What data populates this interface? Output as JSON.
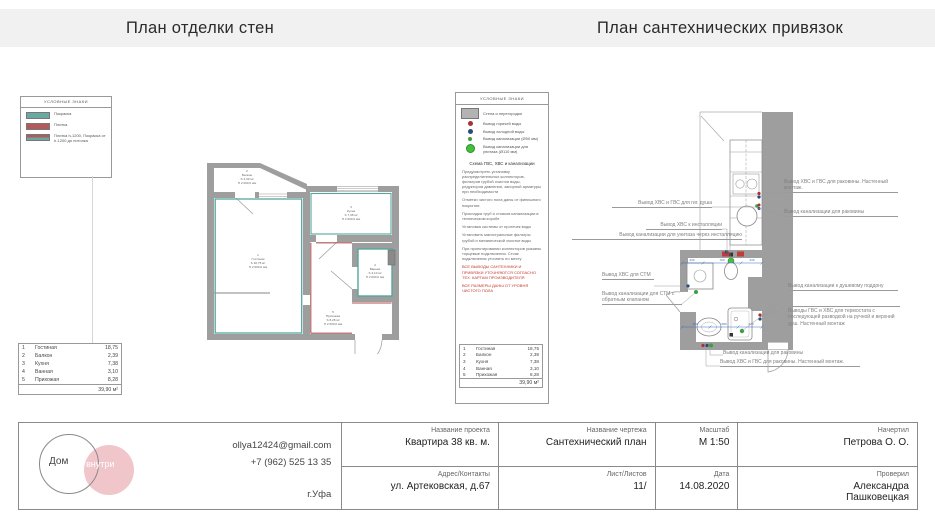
{
  "header": {
    "left_title": "План отделки стен",
    "right_title": "План сантехнических привязок"
  },
  "finish_legend": {
    "title": "УСЛОВНЫЕ ЗНАКИ",
    "items": {
      "paint": "Покраска",
      "tile": "Плитка",
      "mixed": "Плитка h-1200, Покраска от h-1200 до потолка"
    }
  },
  "rooms": {
    "balkon": {
      "num": "2",
      "name": "Балкон",
      "s": "S 2,39 м²",
      "h": "H 2 600,0 мм"
    },
    "gostinaya": {
      "num": "1",
      "name": "Гостиная",
      "s": "S 18,75 м²",
      "h": "H 2 600,0 мм"
    },
    "kuhnya": {
      "num": "3",
      "name": "Кухня",
      "s": "S 7,38 м²",
      "h": "H 2 600,0 мм"
    },
    "vannaya": {
      "num": "4",
      "name": "Ванная",
      "s": "S 3,10 м²",
      "h": "H 2 600,0 мм"
    },
    "prihozhaya": {
      "num": "5",
      "name": "Прихожая",
      "s": "S 8,28 м²",
      "h": "H 2 600,0 мм"
    }
  },
  "room_table": {
    "rows": [
      {
        "n": "1",
        "name": "Гостиная",
        "area": "18,75"
      },
      {
        "n": "2",
        "name": "Балкон",
        "area": "2,39"
      },
      {
        "n": "3",
        "name": "Кухня",
        "area": "7,38"
      },
      {
        "n": "4",
        "name": "Ванная",
        "area": "3,10"
      },
      {
        "n": "5",
        "name": "Прихожая",
        "area": "8,28"
      }
    ],
    "total": "39,90 м²"
  },
  "plumb_legend": {
    "title": "УСЛОВНЫЕ ЗНАКИ",
    "wall": "Стена и перегородки",
    "hot": "Вывод горячей воды",
    "cold": "Вывод холодной воды",
    "sewer50": "Вывод канализации (Ø50 мм)",
    "sewer110": "Вывод канализации для унитаза (Ø110 мм)",
    "scheme_heading": "Схема ГВС, ХВС и канализации",
    "notes": [
      "Предусмотреть установку распределительных коллекторов, фильтров грубой очистки воды, редукторов давления, запорной арматуры при необходимости",
      "Отметки чистого пола даны от финишного покрытия",
      "Прокладка труб и стояков канализации в техническом коробе",
      "Установка системы от протечек воды",
      "Установить магистральные фильтры грубой и механической очистки воды",
      "При проектировании коллекторов указаны торцевые подключения. Стояк подключения уточнить по месту",
      "ВСЕ ВЫВОДЫ САНТЕХНИКИ И ПРИВЯЗКИ УТОЧНЯЮТСЯ СОГЛАСНО ТЕХ. КАРТАМ ПРОИЗВОДИТЕЛЯ",
      "ВСЕ РАЗМЕРЫ ДАНЫ ОТ УРОВНЯ ЧИСТОГО ПОЛА"
    ]
  },
  "plumb": {
    "callouts": {
      "gig_shower": "Вывод ХВС и ГВС для гиг. душа",
      "install_water": "Вывод ХВС к инсталляции",
      "install_sewer": "Вывод канализации для унитаза через инсталляцию",
      "stm_water": "Вывод ХВС для СТМ",
      "stm_sewer": "Вывод канализации для СТМ с обратным клапаном",
      "sink_top_water": "Вывод ХВС и ГВС для раковины. Настенный монтаж.",
      "sink_top_sewer": "Вывод канализации для раковины",
      "shower_sewer": "Вывод канализации к душевому поддону",
      "thermostat": "Выводы ГВС и ХВС для термостата с последующей разводкой на ручной и верхний душ. Настенный монтаж",
      "sink_bottom_sewer": "Вывод канализации для раковины",
      "sink_bottom_water": "Вывод ХВС и ГВС для раковины. Настенный монтаж."
    },
    "dims": {
      "top": [
        "230",
        "700",
        "230"
      ],
      "bottom": [
        "350",
        "680",
        "270"
      ]
    }
  },
  "title_block": {
    "logo": {
      "word1": "Дом",
      "word2": "внутри"
    },
    "contacts": {
      "email": "ollya12424@gmail.com",
      "phone": "+7 (962) 525 13 35",
      "city": "г.Уфа"
    },
    "project": {
      "label": "Название проекта",
      "value": "Квартира 38 кв. м."
    },
    "address": {
      "label": "Адрес/Контакты",
      "value": "ул. Артековская, д.67"
    },
    "drawing": {
      "label": "Название чертежа",
      "value": "Сантехнический план"
    },
    "sheet": {
      "label": "Лист/Листов",
      "value": "11/"
    },
    "scale": {
      "label": "Масштаб",
      "value": "М 1:50"
    },
    "date": {
      "label": "Дата",
      "value": "14.08.2020"
    },
    "author": {
      "label": "Начертил",
      "value": "Петрова О. О."
    },
    "checker": {
      "label": "Проверил",
      "value": "Александра Пашковецкая"
    }
  }
}
